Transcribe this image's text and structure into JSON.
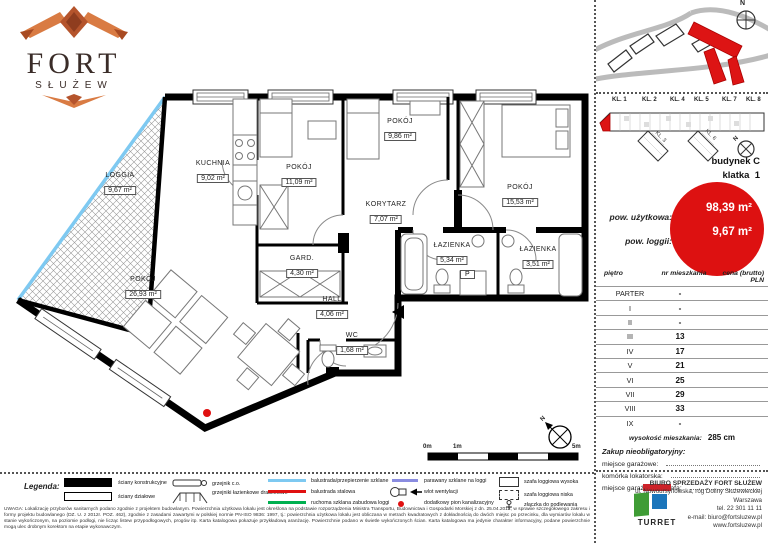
{
  "compass_n": "N",
  "logo": {
    "title": "FORT",
    "subtitle": "SŁUŻEW"
  },
  "plan": {
    "rooms": [
      {
        "name": "LOGGIA",
        "area": "9,67 m²"
      },
      {
        "name": "KUCHNIA",
        "area": "9,02 m²"
      },
      {
        "name": "POKÓJ",
        "area": "11,09 m²"
      },
      {
        "name": "POKÓJ",
        "area": "9,86 m²"
      },
      {
        "name": "POKÓJ",
        "area": "15,53 m²"
      },
      {
        "name": "KORYTARZ",
        "area": "7,07 m²"
      },
      {
        "name": "GARD.",
        "area": "4,30 m²"
      },
      {
        "name": "ŁAZIENKA",
        "area": "5,34 m²"
      },
      {
        "name": "ŁAZIENKA",
        "area": "3,51 m²"
      },
      {
        "name": "HALL",
        "area": "4,06 m²"
      },
      {
        "name": "WC",
        "area": "1,68 m²"
      },
      {
        "name": "POKÓJ",
        "area": "26,93 m²"
      }
    ],
    "washer_label": "P",
    "scale": {
      "start": "0m",
      "mid": "1m",
      "end": "5m"
    }
  },
  "building": {
    "kl_labels": [
      "KL. 1",
      "KL. 2",
      "KL. 4",
      "KL. 5",
      "KL. 7",
      "KL. 8"
    ],
    "wing_labels": [
      "KL. 3",
      "KL. 6"
    ],
    "name": "budynek C",
    "klatka_label": "klatka",
    "klatka_value": "1"
  },
  "areas": {
    "usable_label": "pow. użytkowa:",
    "usable_value": "98,39 m²",
    "loggia_label": "pow. loggii:",
    "loggia_value": "9,67 m²",
    "circle_color": "#dd1111"
  },
  "floors_table": {
    "headers": [
      "piętro",
      "nr mieszkania",
      "cena (brutto) PLN"
    ],
    "rows": [
      {
        "floor": "PARTER",
        "number": "-",
        "price": ""
      },
      {
        "floor": "I",
        "number": "-",
        "price": ""
      },
      {
        "floor": "II",
        "number": "-",
        "price": ""
      },
      {
        "floor": "III",
        "number": "13",
        "price": ""
      },
      {
        "floor": "IV",
        "number": "17",
        "price": ""
      },
      {
        "floor": "V",
        "number": "21",
        "price": ""
      },
      {
        "floor": "VI",
        "number": "25",
        "price": ""
      },
      {
        "floor": "VII",
        "number": "29",
        "price": ""
      },
      {
        "floor": "VIII",
        "number": "33",
        "price": ""
      },
      {
        "floor": "IX",
        "number": "-",
        "price": ""
      }
    ],
    "height_label": "wysokość mieszkania:",
    "height_value": "285 cm"
  },
  "optional": {
    "title": "Zakup nieobligatoryjny:",
    "items": [
      "miejsce garażowe:",
      "komórka lokatorska:",
      "miejsce garażowe z szafą:"
    ]
  },
  "office": {
    "logo_text": "TURRET",
    "lines": [
      "BIURO SPRZEDAŻY FORT SŁUŻEW",
      "ul. Nowoursynowska, róg Doliny Służewieckiej",
      "Warszawa",
      "tel. 22 301 11 11",
      "e-mail: biuro@fortsluzew.pl",
      "www.fortsluzew.pl"
    ]
  },
  "legend": {
    "title": "Legenda:",
    "walls": [
      {
        "label": "ściany konstrukcyjne"
      },
      {
        "label": "ściany działowe"
      }
    ],
    "radiators": [
      {
        "label": "grzejnik c.o."
      },
      {
        "label": "grzejniki łazienkowe drabinkowe"
      }
    ],
    "lines": [
      {
        "label": "balustrada/przepierzenie szklane",
        "color": "#7ec9f1"
      },
      {
        "label": "balustrada stalowa",
        "color": "#e01010"
      },
      {
        "label": "ruchoma szklana zabudowa loggi",
        "color": "#00b050"
      }
    ],
    "marks": [
      {
        "label": "parawany szklane na loggi",
        "color": "#8a8ce0"
      },
      {
        "label": "wlot wentylacji"
      },
      {
        "label": "dodatkowy pion kanalizacyjny",
        "color": "#e01010"
      }
    ],
    "cabinets": [
      {
        "label": "szafa loggiowa wysoka"
      },
      {
        "label": "szafa loggiowa niska"
      },
      {
        "label": "złączka do podlewania"
      }
    ]
  },
  "disclaimer": "UWAGA: Lokalizację przyborów sanitarnych podano zgodnie z projektem budowlanym. Powierzchnia użytkowa lokalu jest określona na podstawie rozporządzenia Ministra Transportu, Budownictwa i Gospodarki Morskiej z dn. 25.04.2012, w sprawie szczegółowego zakresu i formy projektu budowlanego (DZ. U. z 2012r. POZ. 462), zgodnie z zasadami zawartymi w polskiej normie PN-ISO 9836: 1997, tj.: powierzchnia użytkowa lokalu jest obliczana w metrach kwadratowych z dokładnością do dwóch miejsc po przecinku, dla wymiarów lokalu w stanie wykończonym, na poziomie podłogi, nie licząc listew przypodłogowych, progów itp. Karta katalogowa pokazuje przykładową aranżację. Powierzchnie podano w świetle wykończonych ścian. Karta katalogowa ma jedynie charakter informacyjny, podane powierzchnie mogą ulec drobnym korektom na etapie wykonawczym."
}
